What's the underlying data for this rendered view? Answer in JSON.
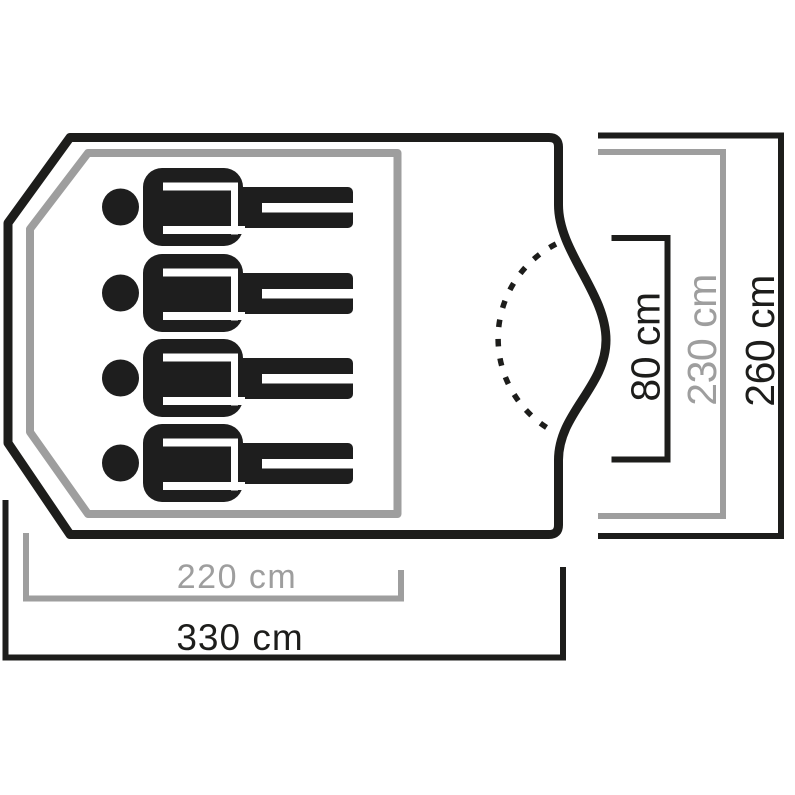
{
  "diagram": {
    "type": "tent-floorplan-top-view",
    "colors": {
      "dark": "#1d1d1b",
      "gray": "#9e9e9e",
      "figure": "#1e1e1e",
      "background": "#ffffff"
    },
    "person_icons": {
      "count": 4,
      "meaning": "sleeping places"
    },
    "labels": {
      "inner_width": "220 cm",
      "outer_width": "330 cm",
      "door_width": "80 cm",
      "inner_depth": "230 cm",
      "outer_depth": "260 cm"
    }
  }
}
